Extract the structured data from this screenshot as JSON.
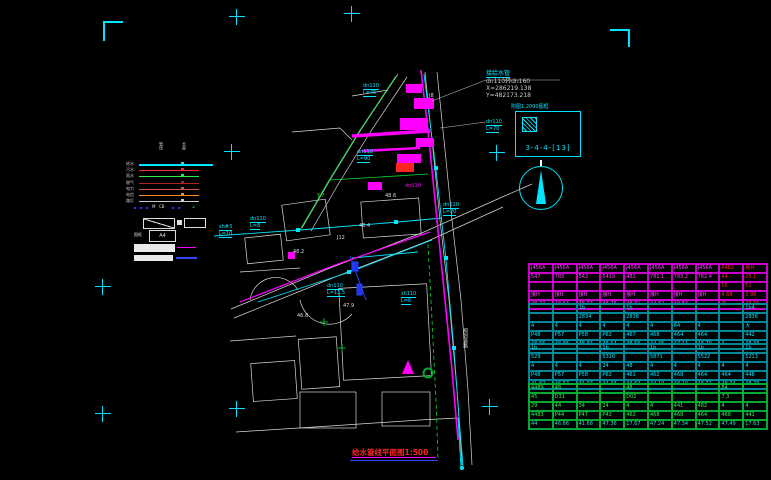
{
  "title": {
    "text": "给水管线平面图1:500"
  },
  "annotation": {
    "name": "接给水管",
    "spec": "dn110转dn160",
    "coord_x": "X=286219.138",
    "coord_y": "Y=482173.218"
  },
  "detail": {
    "note": "附图1:2000图框",
    "label": "3-4-4-[13]"
  },
  "north_arrow": {
    "icon": "north-arrow-icon"
  },
  "colors": {
    "accent": "#00e5ff",
    "pipe": "#ff00ff",
    "alert": "#ff2222",
    "green": "#22cc44"
  },
  "legend": {
    "headers": [
      "管径",
      "长度"
    ],
    "lines": [
      {
        "label": "给水",
        "color": "#00e5ff"
      },
      {
        "label": "污水",
        "color": "#ff2222"
      },
      {
        "label": "雨水",
        "color": "#22ee44"
      },
      {
        "label": "燃气",
        "color": "#aa2222"
      },
      {
        "label": "电力",
        "color": "#cc5544"
      },
      {
        "label": "电信",
        "color": "#ff8822"
      },
      {
        "label": "路灯",
        "color": "#cccccc"
      }
    ],
    "marks": {
      "m1": "M",
      "m2": "CB",
      "m3": "∠"
    },
    "frame_label": "图框",
    "a4": "A4"
  },
  "map_labels": [
    {
      "x": 357,
      "y": 149,
      "t": "dn110",
      "c": "#00e5ff",
      "u": 1
    },
    {
      "x": 357,
      "y": 156,
      "t": "L=90",
      "c": "#00e5ff",
      "u": 1
    },
    {
      "x": 486,
      "y": 119,
      "t": "dn110",
      "c": "#00e5ff",
      "u": 1
    },
    {
      "x": 486,
      "y": 126,
      "t": "L=70",
      "c": "#00e5ff",
      "u": 1
    },
    {
      "x": 363,
      "y": 83,
      "t": "dn110",
      "c": "#00e5ff",
      "u": 1
    },
    {
      "x": 363,
      "y": 90,
      "t": "L=45",
      "c": "#00e5ff",
      "u": 1
    },
    {
      "x": 250,
      "y": 216,
      "t": "dn110",
      "c": "#00e5ff",
      "u": 1
    },
    {
      "x": 250,
      "y": 223,
      "t": "L=8",
      "c": "#00e5ff",
      "u": 1
    },
    {
      "x": 219,
      "y": 224,
      "t": "sh#3",
      "c": "#00e5ff",
      "u": 1
    },
    {
      "x": 219,
      "y": 231,
      "t": "L=10",
      "c": "#00e5ff",
      "u": 1
    },
    {
      "x": 327,
      "y": 283,
      "t": "dn110",
      "c": "#00e5ff",
      "u": 1
    },
    {
      "x": 327,
      "y": 290,
      "t": "L=11.5",
      "c": "#00e5ff",
      "u": 1
    },
    {
      "x": 401,
      "y": 291,
      "t": "sh110",
      "c": "#00e5ff",
      "u": 1
    },
    {
      "x": 401,
      "y": 298,
      "t": "L=6",
      "c": "#00e5ff",
      "u": 1
    },
    {
      "x": 443,
      "y": 202,
      "t": "dn110",
      "c": "#00e5ff",
      "u": 1
    },
    {
      "x": 443,
      "y": 209,
      "t": "L=20",
      "c": "#00e5ff",
      "u": 1
    },
    {
      "x": 293,
      "y": 249,
      "t": "48.2",
      "c": "#dddddd"
    },
    {
      "x": 343,
      "y": 303,
      "t": "47.9",
      "c": "#dddddd"
    },
    {
      "x": 385,
      "y": 193,
      "t": "48.6",
      "c": "#dddddd"
    },
    {
      "x": 297,
      "y": 313,
      "t": "46.8",
      "c": "#dddddd"
    },
    {
      "x": 359,
      "y": 223,
      "t": "48.4",
      "c": "#dddddd"
    },
    {
      "x": 337,
      "y": 235,
      "t": "J12",
      "c": "#dddddd"
    },
    {
      "x": 429,
      "y": 93,
      "t": "J8",
      "c": "#dddddd"
    },
    {
      "x": 405,
      "y": 183,
      "t": "dn110",
      "c": "#ff00ff"
    },
    {
      "x": 317,
      "y": 193,
      "t": "Y-7",
      "c": "#22ee44"
    },
    {
      "x": 462,
      "y": 328,
      "t": "规划道路",
      "c": "#dddddd",
      "v": 1
    }
  ],
  "table": {
    "blocks": [
      {
        "grid": "#cc00cc",
        "text": "#ff44ff",
        "value_row": "#ff44ff",
        "red_cols": [
          8,
          9
        ],
        "red": "#ff2222",
        "top": 263,
        "rows": [
          [
            "J456A",
            "J456A",
            "J456A",
            "J456A",
            "J456A",
            "J456A",
            "J456A",
            "J456A",
            "P482",
            "接片"
          ],
          [
            "547",
            "785",
            "542",
            "5419",
            "481",
            "781.1",
            "783.2",
            "782.4",
            "44",
            "25.1"
          ],
          [
            "",
            "",
            "",
            "",
            "",
            "",
            "",
            "",
            "56",
            "51"
          ],
          [
            "接H",
            "接H",
            "接H",
            "接H",
            "接H",
            "接H",
            "接H",
            "接H",
            "4.68",
            "3.98"
          ],
          [
            "48.74",
            "48.63",
            "48.73",
            "48.76",
            "48.81",
            "44.82",
            "48.84",
            "",
            "接",
            "48.85"
          ]
        ]
      },
      {
        "grid": "#008899",
        "text": "#00e5ff",
        "value_row": "#00e5ff",
        "red_cols": [],
        "red": "#ff2222",
        "top": 303,
        "rows": [
          [
            "",
            "",
            "1b",
            "",
            "1b",
            "",
            "",
            "",
            "",
            "1b4"
          ],
          [
            "",
            "",
            "2834",
            "",
            "2838",
            "",
            "",
            "",
            "",
            "2836"
          ],
          [
            "4",
            "4",
            "4",
            "4",
            "4",
            "4",
            "84",
            "4",
            "",
            "大"
          ],
          [
            "P48",
            "P57",
            "P58",
            "P62",
            "467",
            "468",
            "464",
            "464",
            "",
            "442"
          ],
          [
            "48.66",
            "48.86",
            "48.84",
            "48.64",
            "48.66",
            "44.46",
            "47.11",
            "48.79",
            "4",
            "48.35"
          ]
        ]
      },
      {
        "grid": "#008899",
        "text": "#00e5ff",
        "value_row": "#00e5ff",
        "red_cols": [],
        "red": "#ff2222",
        "top": 343,
        "rows": [
          [
            "1b",
            "",
            "",
            "1b",
            "",
            "1b",
            "",
            "1b",
            "",
            "1b"
          ],
          [
            "529",
            "",
            "",
            "5310",
            "",
            "5871",
            "",
            "5522",
            "",
            "5213"
          ],
          [
            "4",
            "4",
            "4",
            "24",
            "48",
            "4",
            "4",
            "4",
            "4",
            "4"
          ],
          [
            "P48",
            "P57",
            "P58",
            "P62",
            "461",
            "462",
            "468",
            "464",
            "464",
            "448"
          ],
          [
            "41.87",
            "46.57",
            "41.07",
            "44.43",
            "44.62",
            "44.10",
            "48.10",
            "48.71",
            "48.74",
            "48.79"
          ]
        ]
      },
      {
        "grid": "#00aa33",
        "text": "#33ee55",
        "value_row": "#33ddcc",
        "red_cols": [],
        "red": "#ff2222",
        "top": 383,
        "rows": [
          [
            "4489",
            "48",
            "",
            "",
            "48",
            "",
            "",
            "",
            "84",
            ""
          ],
          [
            "45",
            "D31",
            "",
            "",
            "D02",
            "",
            "",
            "",
            "7.3",
            ""
          ],
          [
            "29",
            "44",
            "34",
            "24",
            "4",
            "4",
            "441",
            "482",
            "4",
            "4"
          ],
          [
            "4483",
            "P44",
            "P47",
            "P42",
            "462",
            "468",
            "468",
            "464",
            "468",
            "441"
          ],
          [
            "44",
            "46.66",
            "41.68",
            "47.36",
            "17.67",
            "47.24",
            "47.34",
            "47.52",
            "47.49",
            "17.63"
          ]
        ]
      }
    ]
  }
}
